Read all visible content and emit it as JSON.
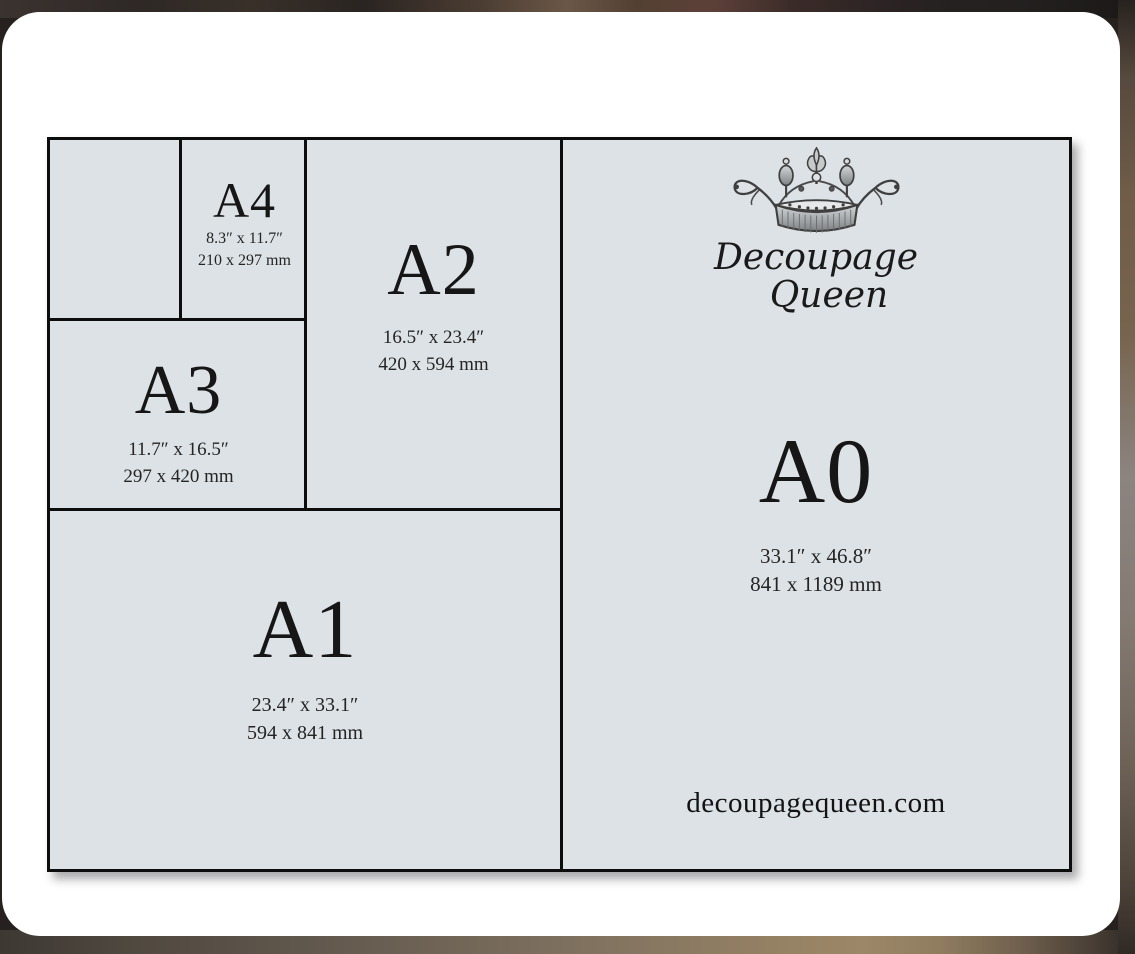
{
  "colors": {
    "panel_fill": "#dde2e6",
    "line": "#0d0d0d",
    "card": "#ffffff",
    "text": "#161616"
  },
  "panels": {
    "blank": {
      "label": ""
    },
    "a4": {
      "label": "A4",
      "inches": "8.3″ x 11.7″",
      "mm": "210 x 297 mm"
    },
    "a3": {
      "label": "A3",
      "inches": "11.7″ x 16.5″",
      "mm": "297 x 420 mm"
    },
    "a2": {
      "label": "A2",
      "inches": "16.5″ x 23.4″",
      "mm": "420 x 594 mm"
    },
    "a1": {
      "label": "A1",
      "inches": "23.4″ x 33.1″",
      "mm": "594 x 841 mm"
    },
    "a0": {
      "label": "A0",
      "inches": "33.1″ x 46.8″",
      "mm": "841 x 1189 mm"
    }
  },
  "brand": {
    "line1": "Decoupage",
    "line2": "Queen",
    "website": "decoupagequeen.com",
    "icon": "crown-icon"
  }
}
